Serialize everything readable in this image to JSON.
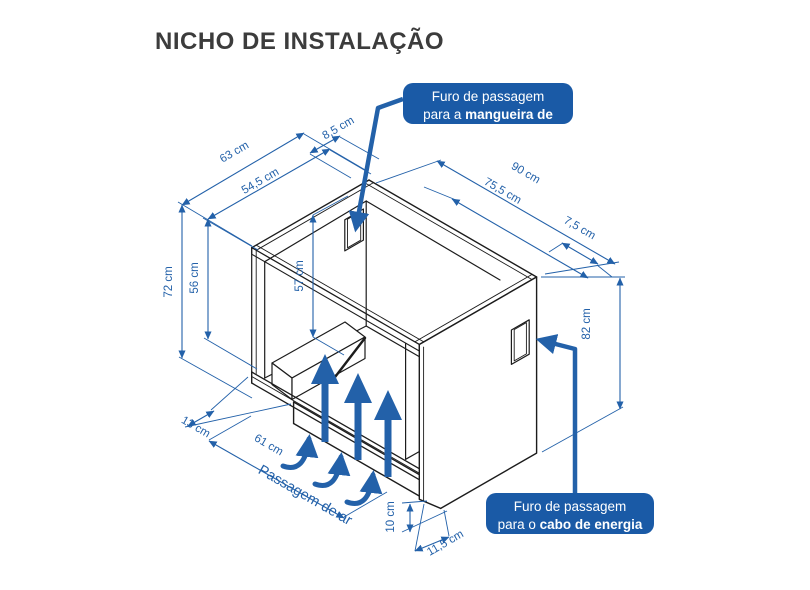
{
  "title": "NICHO DE INSTALAÇÃO",
  "callouts": {
    "gas": {
      "line1": "Furo de passagem",
      "line2_prefix": "para a ",
      "line2_bold": "mangueira de gás"
    },
    "energy": {
      "line1": "Furo de passagem",
      "line2_prefix": "para o ",
      "line2_bold": "cabo de energia"
    }
  },
  "dimensions": {
    "depth_outer": "63 cm",
    "depth_inner": "54,5 cm",
    "back_wall_thickness": "8,5 cm",
    "width_outer": "90 cm",
    "width_inner": "75,5 cm",
    "right_wall_thickness": "7,5 cm",
    "height_outer_left": "72 cm",
    "height_inner_left": "56 cm",
    "height_inner": "57 cm",
    "height_outer_right": "82 cm",
    "base_height": "10 cm",
    "base_depth": "11,5 cm",
    "air_gap_depth": "13 cm",
    "air_opening_width": "61 cm"
  },
  "labels": {
    "air_passage": "Passagem de ar"
  },
  "colors": {
    "accent_blue": "#2361a9",
    "callout_bg": "#1a5aa6",
    "structure_black": "#1c1c1c",
    "title_gray": "#3c3c3c",
    "background": "#ffffff"
  }
}
